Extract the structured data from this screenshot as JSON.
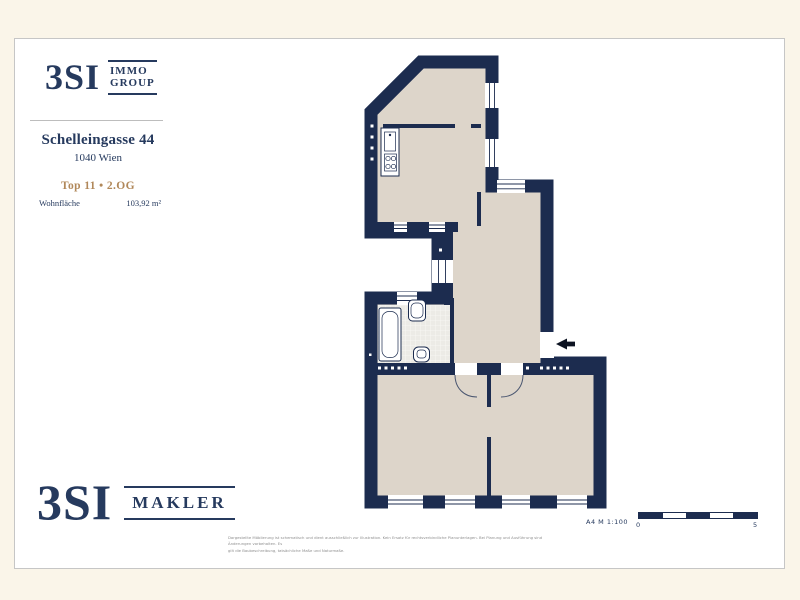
{
  "page": {
    "background_color": "#faf5e9",
    "card_background": "#ffffff",
    "card_border_color": "#c6c6c6"
  },
  "brand_top": {
    "mark": "3SI",
    "line1": "IMMO",
    "line2": "GROUP"
  },
  "listing": {
    "street": "Schelleingasse 44",
    "city": "1040 Wien",
    "unit": "Top 11 • 2.OG",
    "area_label": "Wohnfläche",
    "area_value": "103,92 m²"
  },
  "brand_bottom": {
    "mark": "3SI",
    "word": "MAKLER"
  },
  "plan": {
    "wall_color": "#1c2c4f",
    "floor_color": "#ddd5ca",
    "tile_color": "#ecebe6",
    "scale_note": "A4  M 1:100",
    "scale_start": "0",
    "scale_end": "5"
  },
  "footer": {
    "disclaimer_line1": "Dargestellte Möblierung ist schematisch und dient ausschließlich zur Illustration. Kein Ersatz für rechtsverbindliche Planunterlagen. Bei Planung und Ausführung sind Änderungen vorbehalten. Es",
    "disclaimer_line2": "gilt die Baubeschreibung, tatsächliche Maße und Naturmaße."
  }
}
